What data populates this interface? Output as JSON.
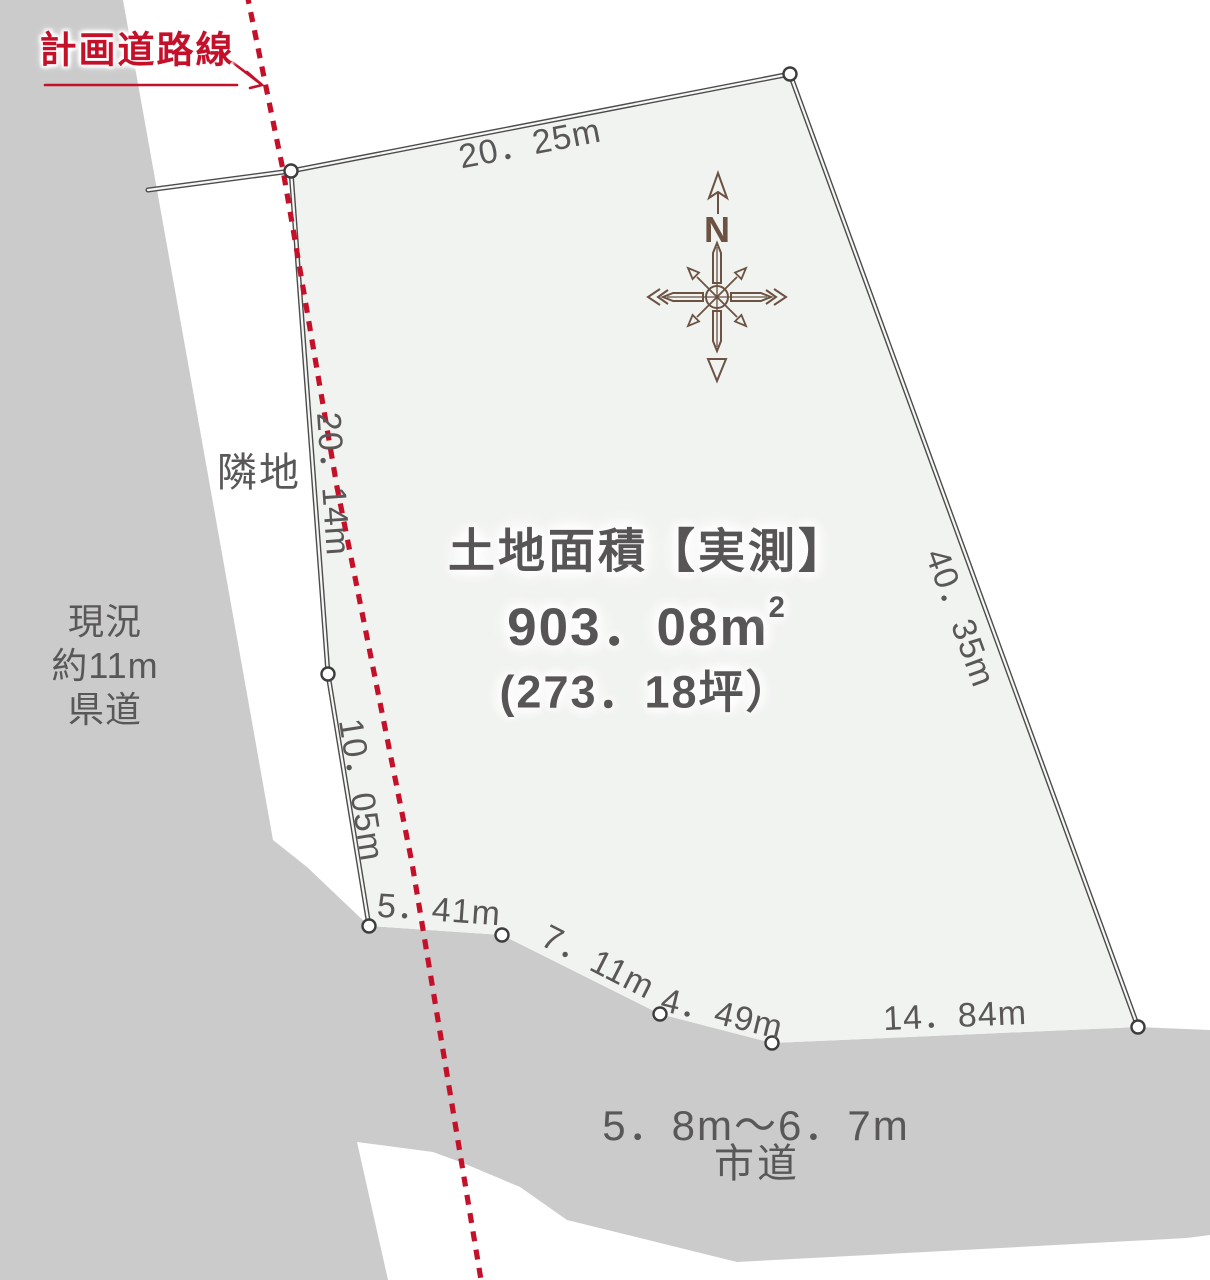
{
  "colors": {
    "background": "#ffffff",
    "surround_gray": "#cbcbcb",
    "plot_fill": "#f1f3f0",
    "boundary_line": "#4c4c4c",
    "text_gray": "#595757",
    "accent_red": "#c5102a",
    "compass_brown": "#6b5243"
  },
  "labels": {
    "planned_road": "計画道路線",
    "neighbor_lot": "隣地",
    "prefectural_road_lines": [
      "現況",
      "約11m",
      "県道"
    ],
    "city_road_width": "5．8m〜6．7m",
    "city_road_name": "市道"
  },
  "area": {
    "title": "土地面積【実測】",
    "sqm_main": "903．08m",
    "sqm_sup": "2",
    "tsubo": "(273．18坪）"
  },
  "dimensions": {
    "top": "20．25m",
    "left_upper": "20．14m",
    "left_lower": "10．05m",
    "bottom_a": "5．41m",
    "bottom_b": "7．11m",
    "bottom_c": "4．49m",
    "bottom_d": "14．84m",
    "right": "40．35m"
  },
  "compass": {
    "n": "N"
  }
}
